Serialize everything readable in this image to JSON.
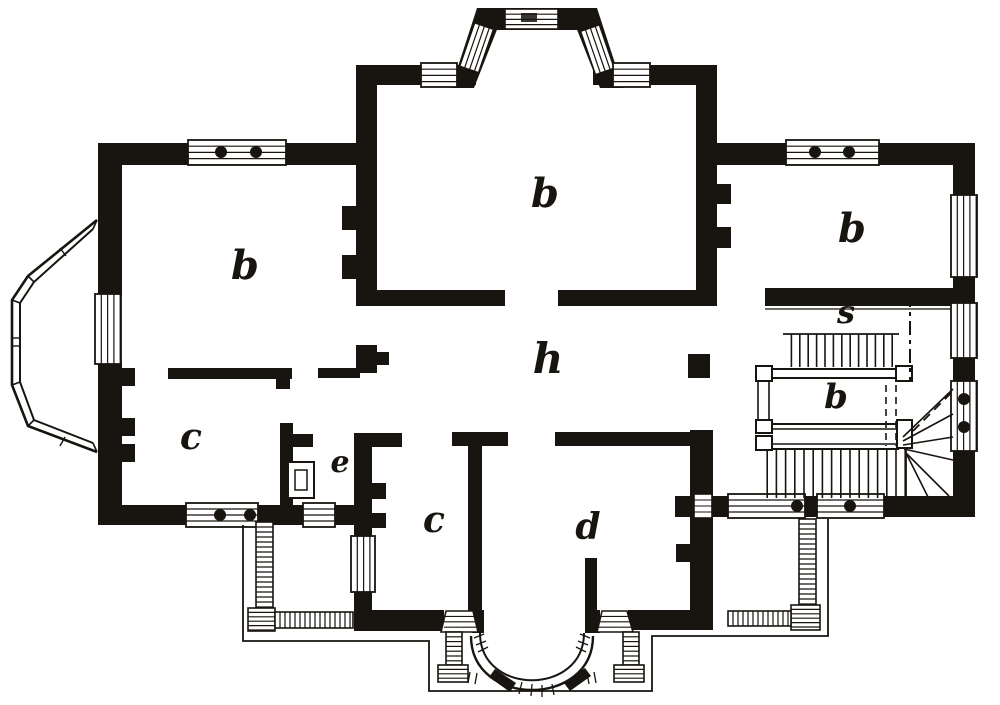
{
  "canvas": {
    "width": 1000,
    "height": 705
  },
  "colors": {
    "ink": "#18140f",
    "paper": "#ffffff"
  },
  "rooms": [
    {
      "id": "room-b-left",
      "label": "b",
      "x": 245,
      "y": 266,
      "size": 40
    },
    {
      "id": "room-b-center",
      "label": "b",
      "x": 545,
      "y": 194,
      "size": 40
    },
    {
      "id": "room-b-right",
      "label": "b",
      "x": 852,
      "y": 229,
      "size": 40
    },
    {
      "id": "hall-h",
      "label": "h",
      "x": 548,
      "y": 359,
      "size": 42
    },
    {
      "id": "stair-s",
      "label": "s",
      "x": 846,
      "y": 312,
      "size": 32
    },
    {
      "id": "stair-landing-b",
      "label": "b",
      "x": 836,
      "y": 397,
      "size": 34
    },
    {
      "id": "room-c-left",
      "label": "c",
      "x": 191,
      "y": 437,
      "size": 36
    },
    {
      "id": "room-e",
      "label": "e",
      "x": 340,
      "y": 463,
      "size": 30
    },
    {
      "id": "room-c-bottom",
      "label": "c",
      "x": 434,
      "y": 520,
      "size": 36
    },
    {
      "id": "room-d",
      "label": "d",
      "x": 588,
      "y": 527,
      "size": 36
    }
  ]
}
